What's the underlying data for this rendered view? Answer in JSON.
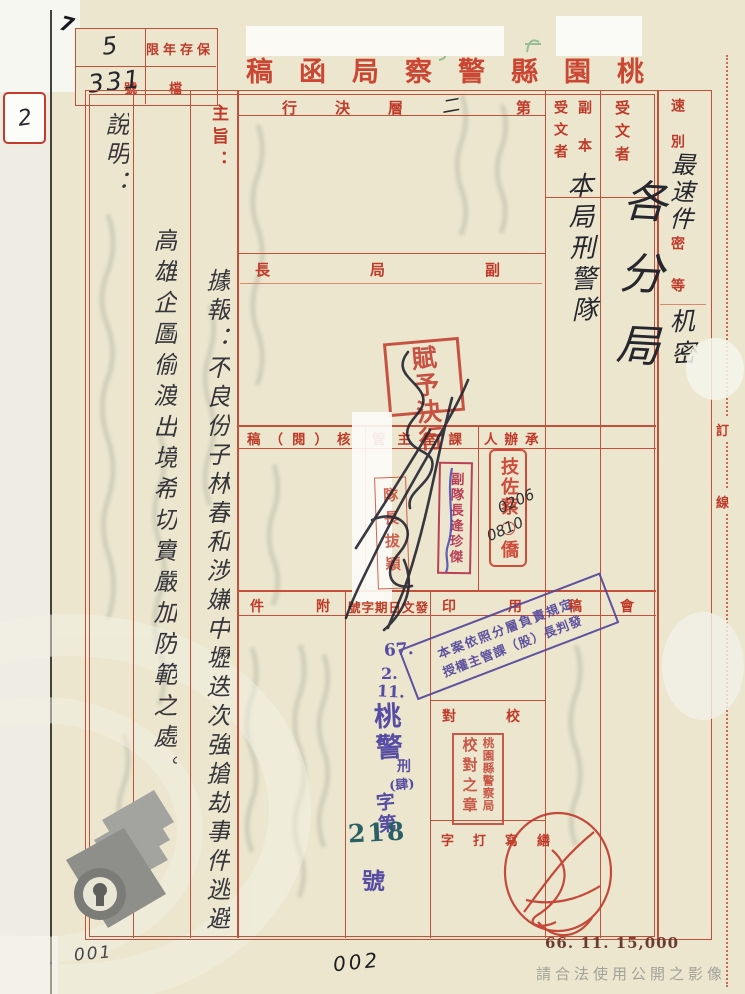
{
  "document": {
    "corner_mark": "7",
    "side_label": "2",
    "archive_box": {
      "retention_label": "保存年限",
      "retention_value": "5",
      "file_label": "檔號",
      "file_value": "331"
    },
    "title": "桃園縣警察局函稿",
    "binding": {
      "top": "訂",
      "bottom": "線"
    }
  },
  "header": {
    "speed": {
      "label": "速別",
      "value": "最速件"
    },
    "security": {
      "label": "密等",
      "value": "机密"
    },
    "recipient": {
      "label": "受文者",
      "value": "各分局"
    },
    "copy": {
      "label_top": "副本",
      "label_bottom": "受文者",
      "value": "本局刑警隊"
    },
    "decision": {
      "prefix": "第",
      "value": "二",
      "suffix": "層決行"
    }
  },
  "approval": {
    "deputy_chief_label": "副局長",
    "grant_stamp": "賦予決行"
  },
  "review": {
    "check_label": "核（閱）稿",
    "section_label": "課室主管",
    "handler_label": "承辦人",
    "handler_stamp": "技佐蔡○僑",
    "handler_notes": [
      "0206",
      "0810"
    ],
    "deputy_stamp": "副隊長逄珍傑",
    "chief_stamp": "隊長拔穎"
  },
  "subject": {
    "label": "主旨：",
    "line1": "據報：不良份子林春和涉嫌中壢迭次強搶劫事件逃避",
    "line2": "高雄企圖偷渡出境希切實嚴加防範之處。",
    "explanation_label": "說明："
  },
  "dispatch": {
    "attachment_label": "附件",
    "date_number_label": "發文日期字號",
    "seal_label": "用印",
    "draft_label": "稿",
    "meeting_label": "會",
    "date_stamp": {
      "year": "67.",
      "month": "2.",
      "day": "11.",
      "org": "桃警",
      "unit": "刑",
      "unit_paren": "(肆)",
      "word": "字第",
      "number": "218",
      "suffix": "號"
    },
    "delegation_stamp_line1": "本案依照分層負責規定",
    "delegation_stamp_line2": "授權主管課（股）長判發",
    "proofread_label": "校對",
    "proofread_stamp_org": "桃園縣警察局",
    "proofread_stamp_text": "校對之章",
    "typing_label": "繕寫打字"
  },
  "footer": {
    "print_code": "66. 11. 15,000",
    "page_left": "001",
    "page_center": "002",
    "watermark": "請合法使用公開之影像"
  }
}
